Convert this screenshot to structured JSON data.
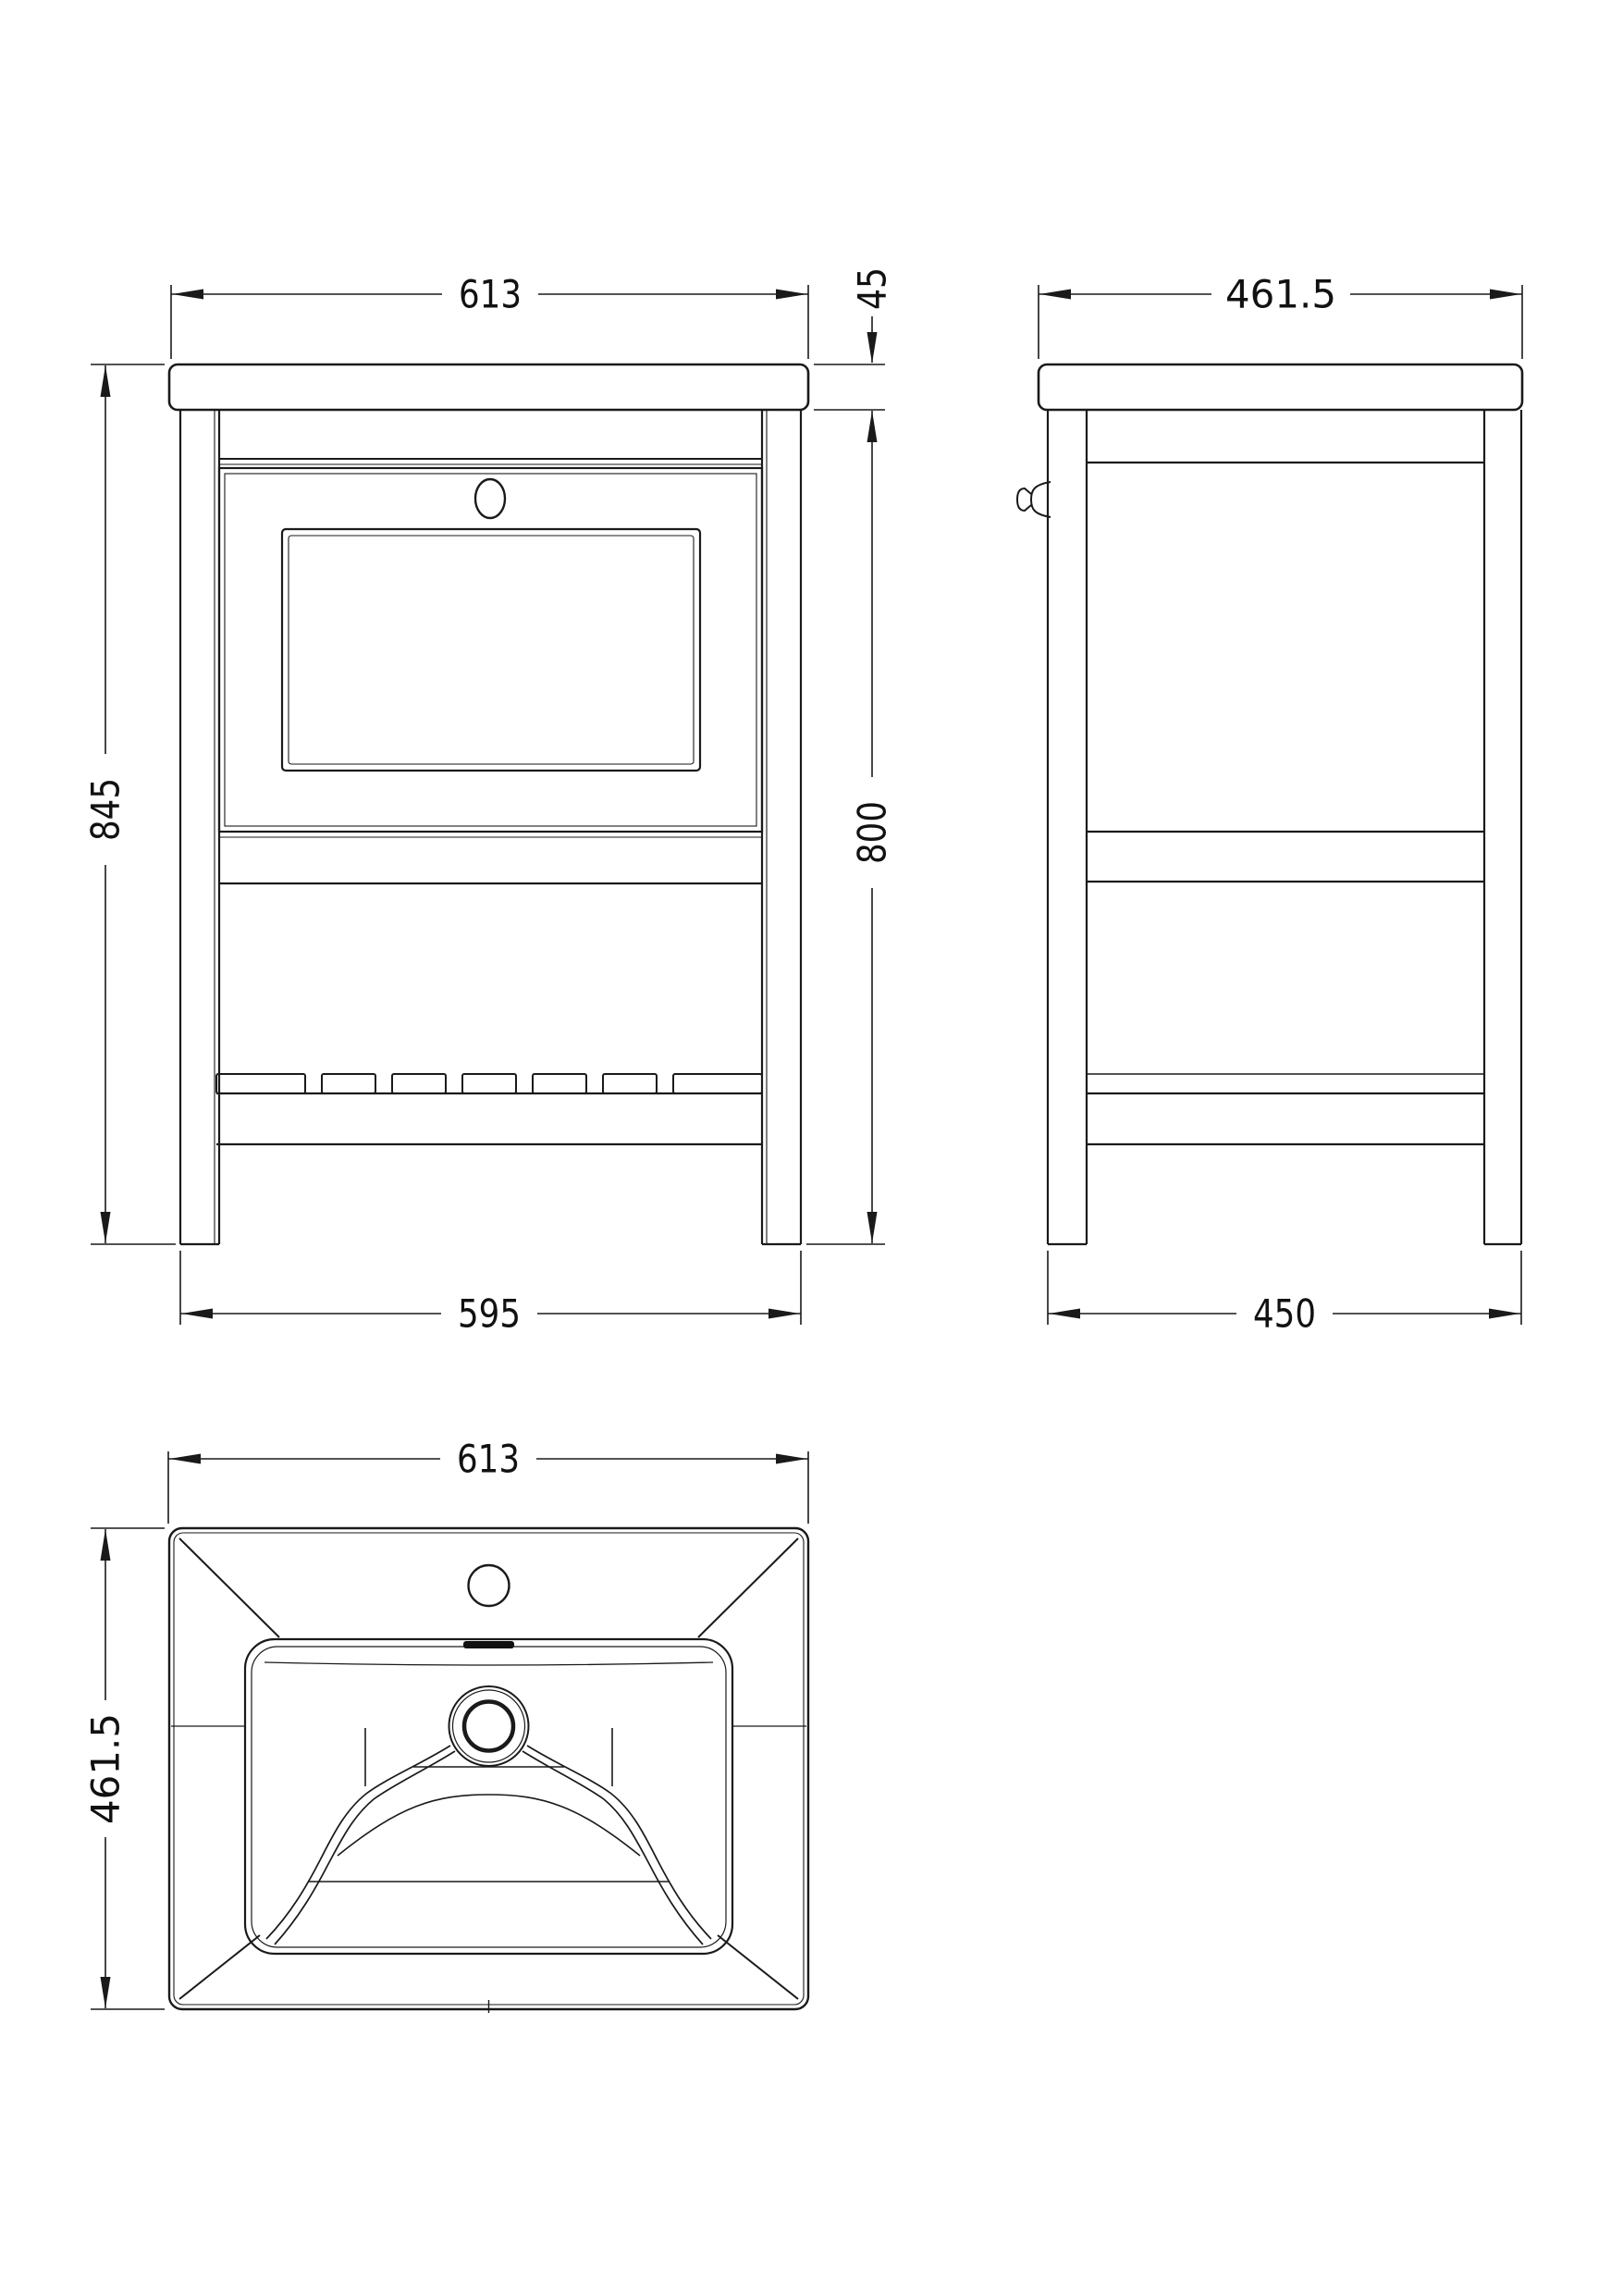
{
  "drawing": {
    "colors": {
      "background": "#ffffff",
      "line": "#1a1a1a",
      "dimension_line": "#1a1a1a",
      "text": "#111111"
    },
    "front": {
      "width": "613",
      "top_thickness": "45",
      "overall_height": "845",
      "cabinet_height": "800",
      "base_width": "595"
    },
    "side": {
      "depth": "461.5",
      "base_depth": "450"
    },
    "basin": {
      "width": "613",
      "depth": "461.5"
    }
  }
}
